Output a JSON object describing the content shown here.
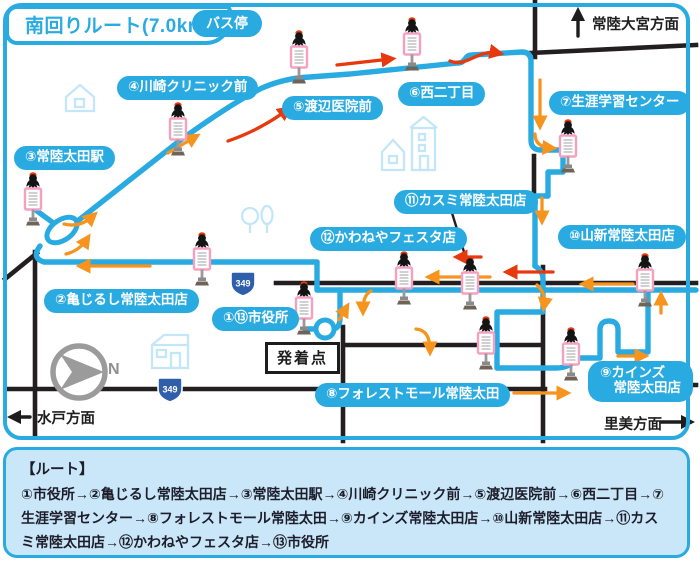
{
  "title": "南回りルート(7.0km)",
  "legend": {
    "bus_stop": "バス停"
  },
  "directions": {
    "north": "常陸大宮方面",
    "west": "水戸方面",
    "east": "里美方面"
  },
  "compass": {
    "label": "N"
  },
  "start_point": {
    "label": "発着点"
  },
  "route_shield": {
    "number": "349"
  },
  "stops": [
    {
      "label": "①⑬市役所"
    },
    {
      "label": "②亀じるし常陸太田店"
    },
    {
      "label": "③常陸太田駅"
    },
    {
      "label": "④川崎クリニック前"
    },
    {
      "label": "⑤渡辺医院前"
    },
    {
      "label": "⑥西二丁目"
    },
    {
      "label": "⑦生涯学習センター"
    },
    {
      "label": "⑧フォレストモール常陸太田"
    },
    {
      "label": "⑨カインズ\n　常陸太田店"
    },
    {
      "label": "⑩山新常陸太田店"
    },
    {
      "label": "⑪カスミ常陸太田店"
    },
    {
      "label": "⑫かわねやフェスタ店"
    }
  ],
  "route_info": {
    "heading": "【ルート】",
    "description": "①市役所→②亀じるし常陸太田店→③常陸太田駅→④川崎クリニック前→⑤渡辺医院前→⑥西二丁目→⑦生涯学習センター→⑧フォレストモール常陸太田→⑨カインズ常陸太田店→⑩山新常陸太田店→⑪カスミ常陸太田店→⑫かわねやフェスタ店→⑬市役所"
  },
  "icons": {
    "bus_stop": "bus-stop-sign-with-bird",
    "compass": "compass-arrow",
    "roundabout": "loop-circle"
  },
  "colors": {
    "accent_blue": "#29abe2",
    "road_black": "#231f20",
    "arrow_orange": "#f7941d",
    "arrow_red": "#e8380d",
    "stop_sign_pink": "#f5a0c0",
    "info_bg": "#c9e7f8",
    "shield_blue": "#2f5eab"
  }
}
